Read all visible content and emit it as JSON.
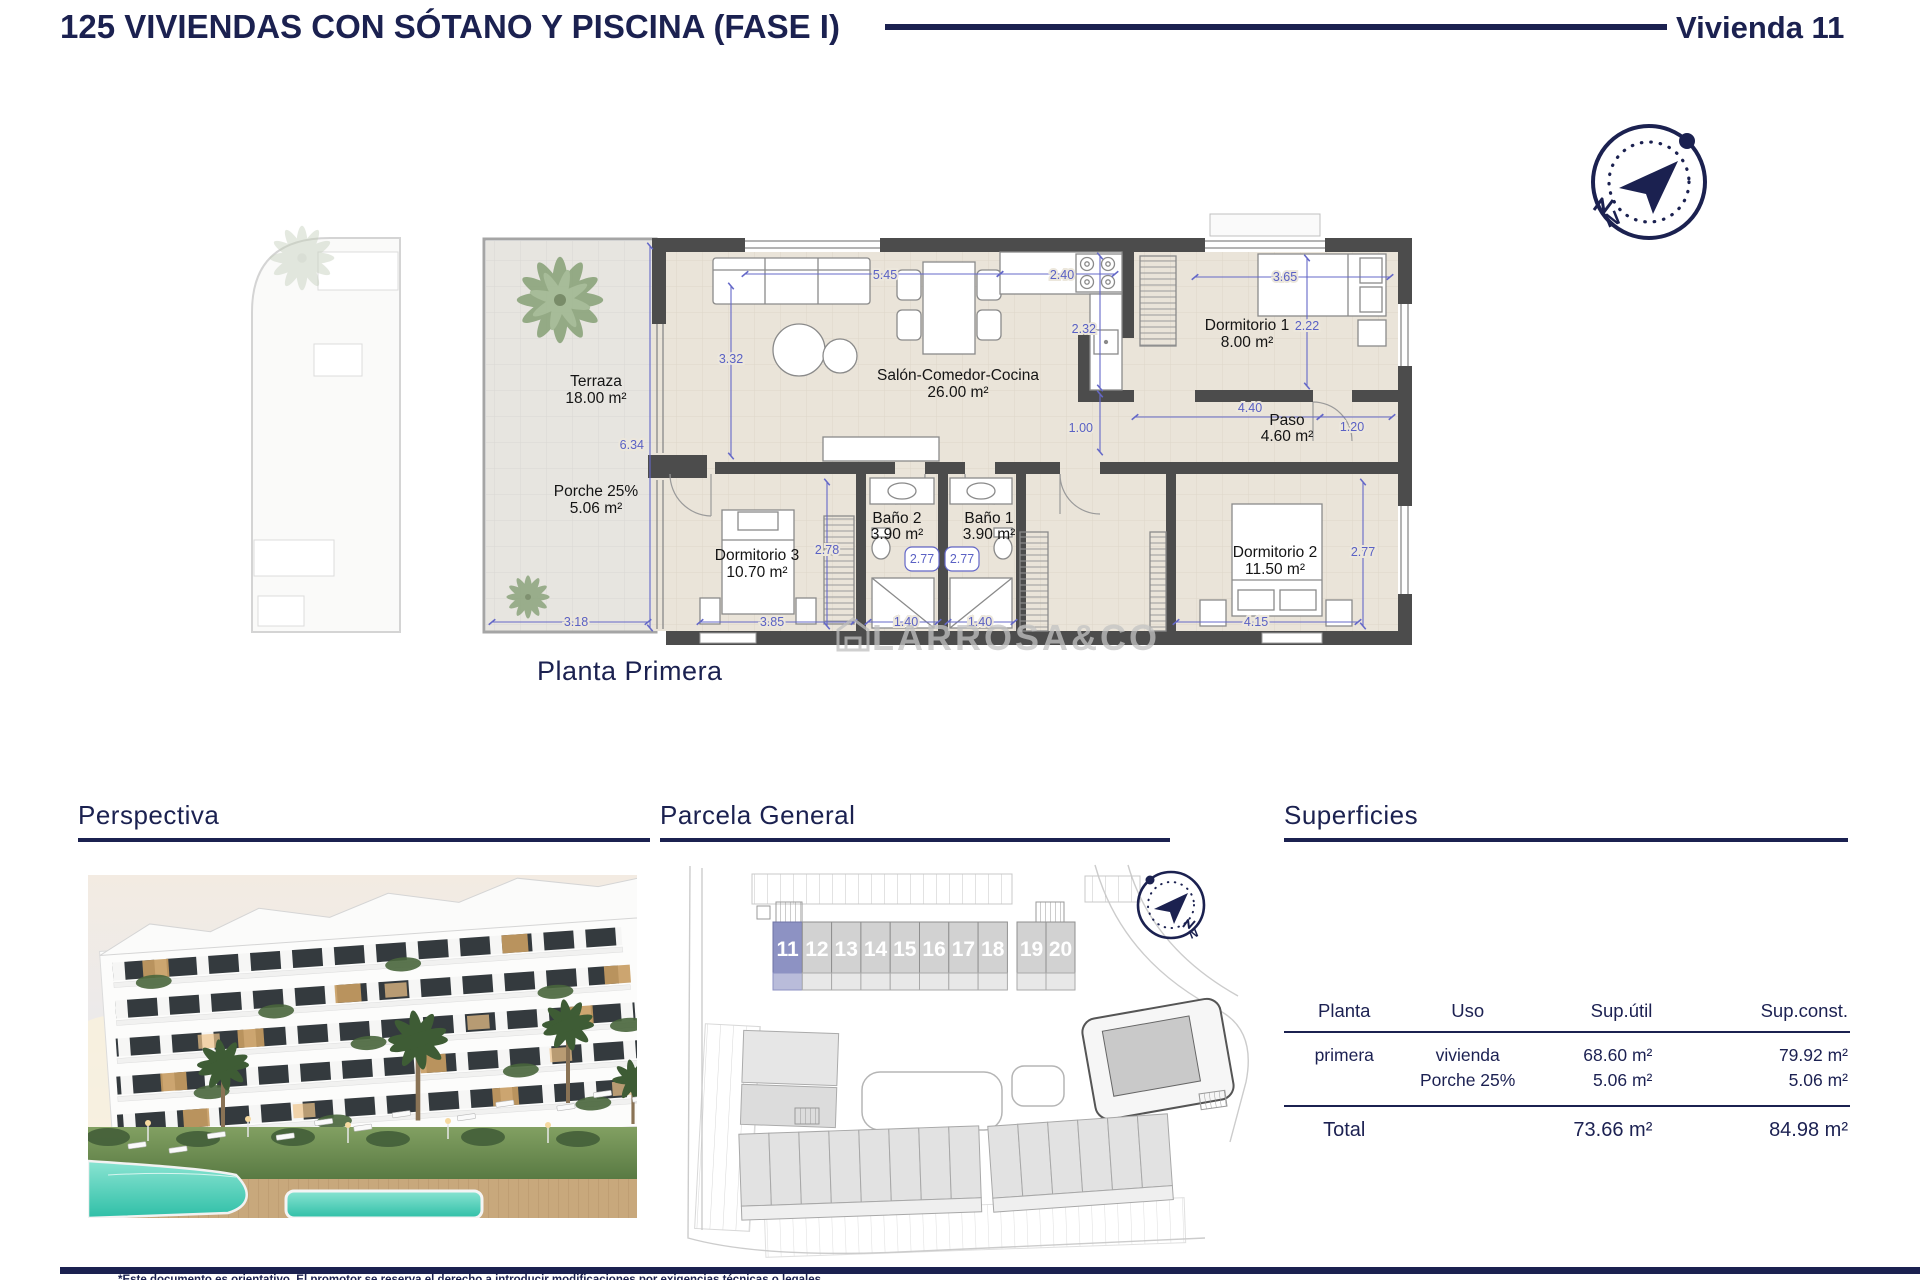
{
  "header": {
    "title": "125 VIVIENDAS CON SÓTANO Y PISCINA (FASE I)",
    "unit_label": "Vivienda 11"
  },
  "plan": {
    "caption": "Planta Primera",
    "watermark": "LARROSA&CO",
    "rooms": [
      {
        "name": "Terraza",
        "area": "18.00 m²"
      },
      {
        "name": "Porche 25%",
        "area": "5.06 m²"
      },
      {
        "name": "Salón-Comedor-Cocina",
        "area": "26.00 m²"
      },
      {
        "name": "Dormitorio 1",
        "area": "8.00 m²"
      },
      {
        "name": "Paso",
        "area": "4.60 m²"
      },
      {
        "name": "Dormitorio 3",
        "area": "10.70 m²"
      },
      {
        "name": "Baño 2",
        "area": "3.90 m²"
      },
      {
        "name": "Baño 1",
        "area": "3.90 m²"
      },
      {
        "name": "Dormitorio 2",
        "area": "11.50 m²"
      }
    ],
    "dims": {
      "salon_w": "5.45",
      "kitchen_w": "2.40",
      "dorm1_w": "3.65",
      "kitchen_d": "2.32",
      "dorm1_d": "2.22",
      "salon_h": "3.32",
      "terraza_h": "6.34",
      "paso_w": "4.40",
      "paso_s": "1.20",
      "kitchen_pass": "1.00",
      "dorm3_h": "2.78",
      "bath2_door": "2.77",
      "bath1_door": "2.77",
      "porche_w": "3.18",
      "dorm3_w": "3.85",
      "bath2_w": "1.40",
      "bath1_w": "1.40",
      "dorm2_w": "4.15",
      "dorm2_h": "2.77"
    }
  },
  "sections": {
    "perspectiva": "Perspectiva",
    "parcela": "Parcela General",
    "superficies": "Superficies"
  },
  "parcela": {
    "units": [
      "11",
      "12",
      "13",
      "14",
      "15",
      "16",
      "17",
      "18",
      "19",
      "20"
    ],
    "highlighted_unit": "11"
  },
  "superficies": {
    "columns": [
      "Planta",
      "Uso",
      "Sup.útil",
      "Sup.const."
    ],
    "rows": [
      {
        "planta": "primera",
        "uso": "vivienda",
        "sup_util": "68.60 m²",
        "sup_const": "79.92 m²"
      },
      {
        "planta": "",
        "uso": "Porche 25%",
        "sup_util": "5.06 m²",
        "sup_const": "5.06 m²"
      }
    ],
    "total": {
      "label": "Total",
      "sup_util": "73.66 m²",
      "sup_const": "84.98 m²"
    }
  },
  "footer": {
    "note": "*Este documento es orientativo. El promotor se reserva el derecho a introducir modificaciones por exigencias técnicas o legales."
  },
  "colors": {
    "navy": "#1b2150",
    "dim_blue": "#5a61c4",
    "wall": "#4c4c4c",
    "floor": "#eae4d9",
    "unit_highlight": "#8d92c3",
    "pool": "#52cdb9"
  }
}
